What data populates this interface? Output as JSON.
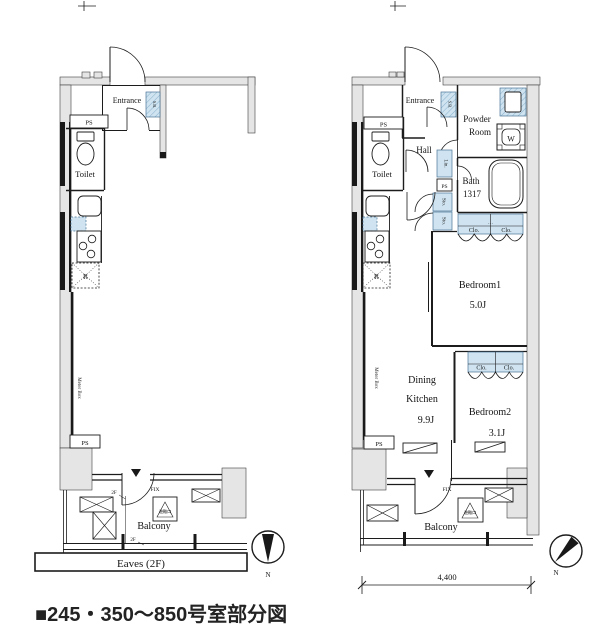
{
  "caption": "■245・350〜850号室部分図",
  "colors": {
    "fixture_blue": "#cfe3f0",
    "wall_gray": "#e5e5e5",
    "line": "#1c1c1c"
  },
  "plans": {
    "left": {
      "entrance": "Entrance",
      "shoe_box": "S.B.",
      "ps_top": "PS",
      "toilet": "Toilet",
      "fridge": "R",
      "meter_box": "Meter Box",
      "ps_bottom": "PS",
      "fix": "FIX",
      "hatch": "避難口",
      "balcony": "Balcony",
      "floor_mark_upper": "2F",
      "floor_mark_lower": "2F",
      "eaves": "Eaves (2F)",
      "north": "N"
    },
    "right": {
      "entrance": "Entrance",
      "shoe_box": "S.B.",
      "powder_room_line1": "Powder",
      "powder_room_line2": "Room",
      "washer": "W",
      "hall": "Hall",
      "toilet": "Toilet",
      "ps_top": "PS",
      "linen": "Lin.",
      "ps_mid": "PS",
      "storage_upper": "Sto.",
      "storage_lower": "Sto.",
      "bath_line1": "Bath",
      "bath_line2": "1317",
      "closet_dots": "…",
      "closet_bath_1": "Clo.",
      "closet_bath_2": "Clo.",
      "bedroom1": "Bedroom1",
      "bedroom1_size": "5.0J",
      "dining_line1": "Dining",
      "dining_line2": "Kitchen",
      "dining_size": "9.9J",
      "closet_bed2_1": "Clo.",
      "closet_bed2_2": "Clo.",
      "bedroom2": "Bedroom2",
      "bedroom2_size": "3.1J",
      "fridge": "R",
      "meter_box": "Meter Box",
      "ps_bottom": "PS",
      "fix": "FIX",
      "hatch": "避難口",
      "balcony": "Balcony",
      "dimension": "4,400",
      "north": "N"
    }
  }
}
